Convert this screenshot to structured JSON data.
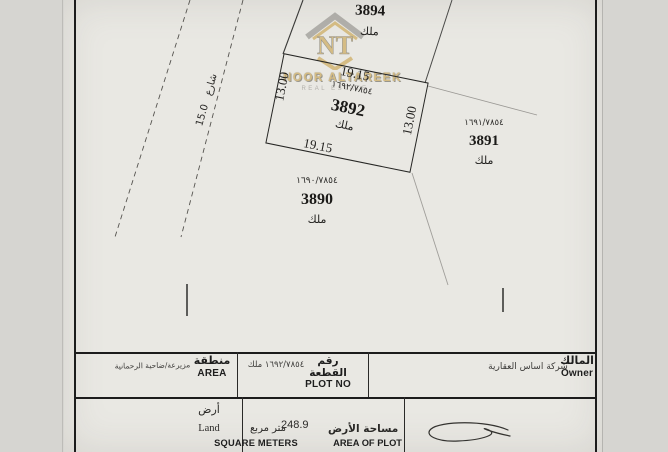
{
  "colors": {
    "paper": "#e9e8e3",
    "ink": "#1c1c1c",
    "watermark_gold": "#c9a24b",
    "watermark_gray": "#8f8d88"
  },
  "map": {
    "street": {
      "name_ar": "شارع",
      "width": "15.0"
    },
    "center": {
      "number": "3892",
      "ref": "١٦٩٢/٧٨٥٤",
      "tenure_ar": "ملك",
      "dim_top": "19.15",
      "dim_bottom": "19.15",
      "dim_left": "13.00",
      "dim_right": "13.00"
    },
    "top": {
      "number": "3894",
      "ref": "١٦٩٤/٧٨٥٤",
      "tenure_ar": "ملك"
    },
    "right": {
      "number": "3891",
      "ref": "١٦٩١/٧٨٥٤",
      "tenure_ar": "ملك"
    },
    "bottom": {
      "number": "3890",
      "ref": "١٦٩٠/٧٨٥٤",
      "tenure_ar": "ملك"
    }
  },
  "watermark": {
    "monogram": "NT",
    "name": "NOOR ALTAREEK",
    "tagline": "REAL ESTATE"
  },
  "table": {
    "area": {
      "label_ar": "منطقة",
      "label_en": "AREA",
      "value_ar": "مزيرعة/ضاحية الرحمانية"
    },
    "plot_no": {
      "label_ar": "رقم القطعة",
      "label_en": "PLOT NO",
      "value_ar": "١٦٩٢/٧٨٥٤ ملك"
    },
    "owner": {
      "label_ar": "المالك",
      "label_en": "Owner",
      "value_ar": "شركة اساس العقارية"
    },
    "land": {
      "value_ar": "أرض",
      "value_en": "Land"
    },
    "plot_area": {
      "value": "248.9",
      "unit_ar": "متر مربع",
      "unit_en": "SQUARE METERS",
      "label_ar": "مساحة الأرض",
      "label_en": "AREA OF PLOT"
    }
  }
}
